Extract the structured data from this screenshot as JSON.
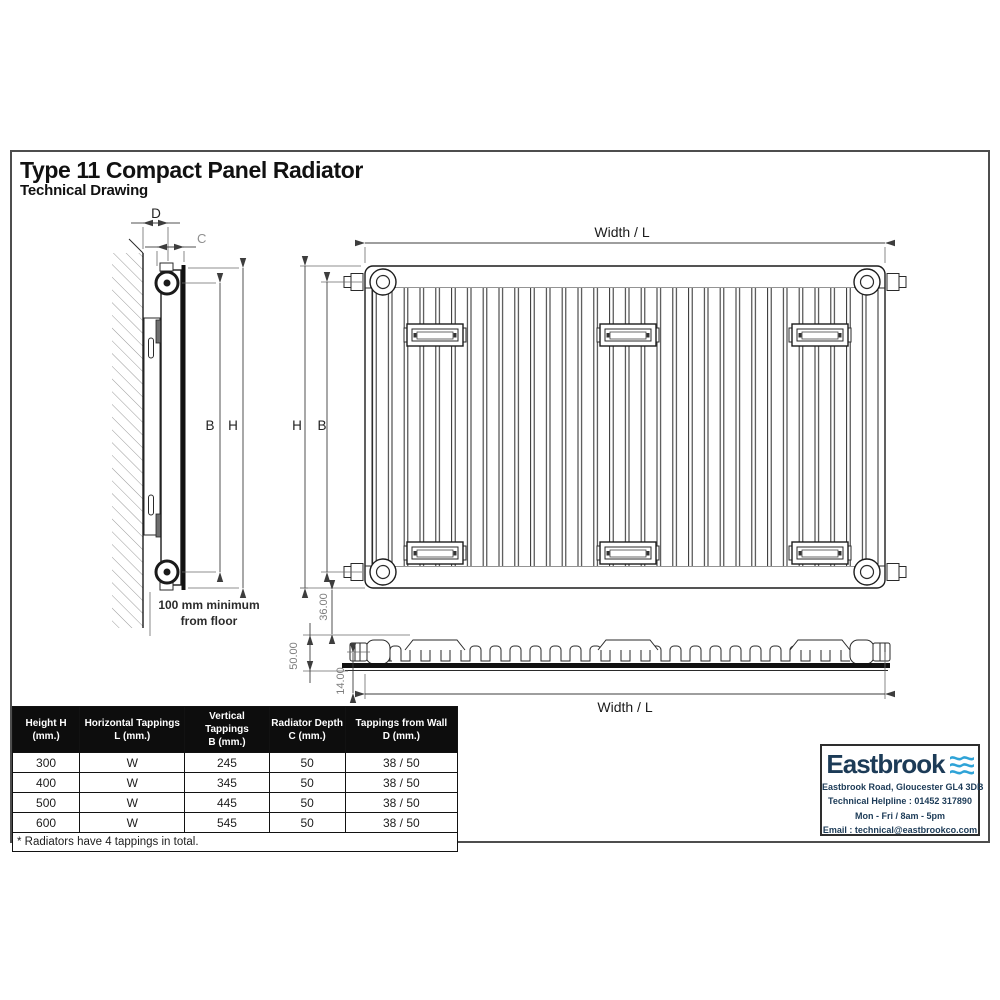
{
  "page": {
    "title": "Type 11 Compact Panel Radiator",
    "subtitle": "Technical Drawing"
  },
  "side_view": {
    "dim_d": "D",
    "dim_c": "C",
    "dim_b": "B",
    "dim_h": "H",
    "floor_note_1": "100 mm minimum",
    "floor_note_2": "from floor"
  },
  "front_view": {
    "width_label": "Width / L",
    "dim_h": "H",
    "dim_b": "B"
  },
  "plan_view": {
    "dim_36": "36.00",
    "dim_50": "50.00",
    "dim_14": "14.00",
    "width_label": "Width / L"
  },
  "spec_table": {
    "headers": [
      {
        "line1": "Height H",
        "line2": "(mm.)"
      },
      {
        "line1": "Horizontal Tappings",
        "line2": "L (mm.)"
      },
      {
        "line1": "Vertical Tappings",
        "line2": "B (mm.)"
      },
      {
        "line1": "Radiator Depth",
        "line2": "C (mm.)"
      },
      {
        "line1": "Tappings from Wall",
        "line2": "D (mm.)"
      }
    ],
    "rows": [
      [
        "300",
        "W",
        "245",
        "50",
        "38 / 50"
      ],
      [
        "400",
        "W",
        "345",
        "50",
        "38 / 50"
      ],
      [
        "500",
        "W",
        "445",
        "50",
        "38 / 50"
      ],
      [
        "600",
        "W",
        "545",
        "50",
        "38 / 50"
      ]
    ],
    "footnote": "* Radiators have 4 tappings in total."
  },
  "brand": {
    "name": "Eastbrook",
    "address": "Eastbrook Road, Gloucester GL4 3DB",
    "helpline": "Technical Helpline : 01452 317890",
    "hours": "Mon - Fri / 8am - 5pm",
    "email": "Email : technical@eastbrookco.com",
    "colors": {
      "navy": "#1c3b57",
      "blue": "#2fa3d7"
    }
  }
}
